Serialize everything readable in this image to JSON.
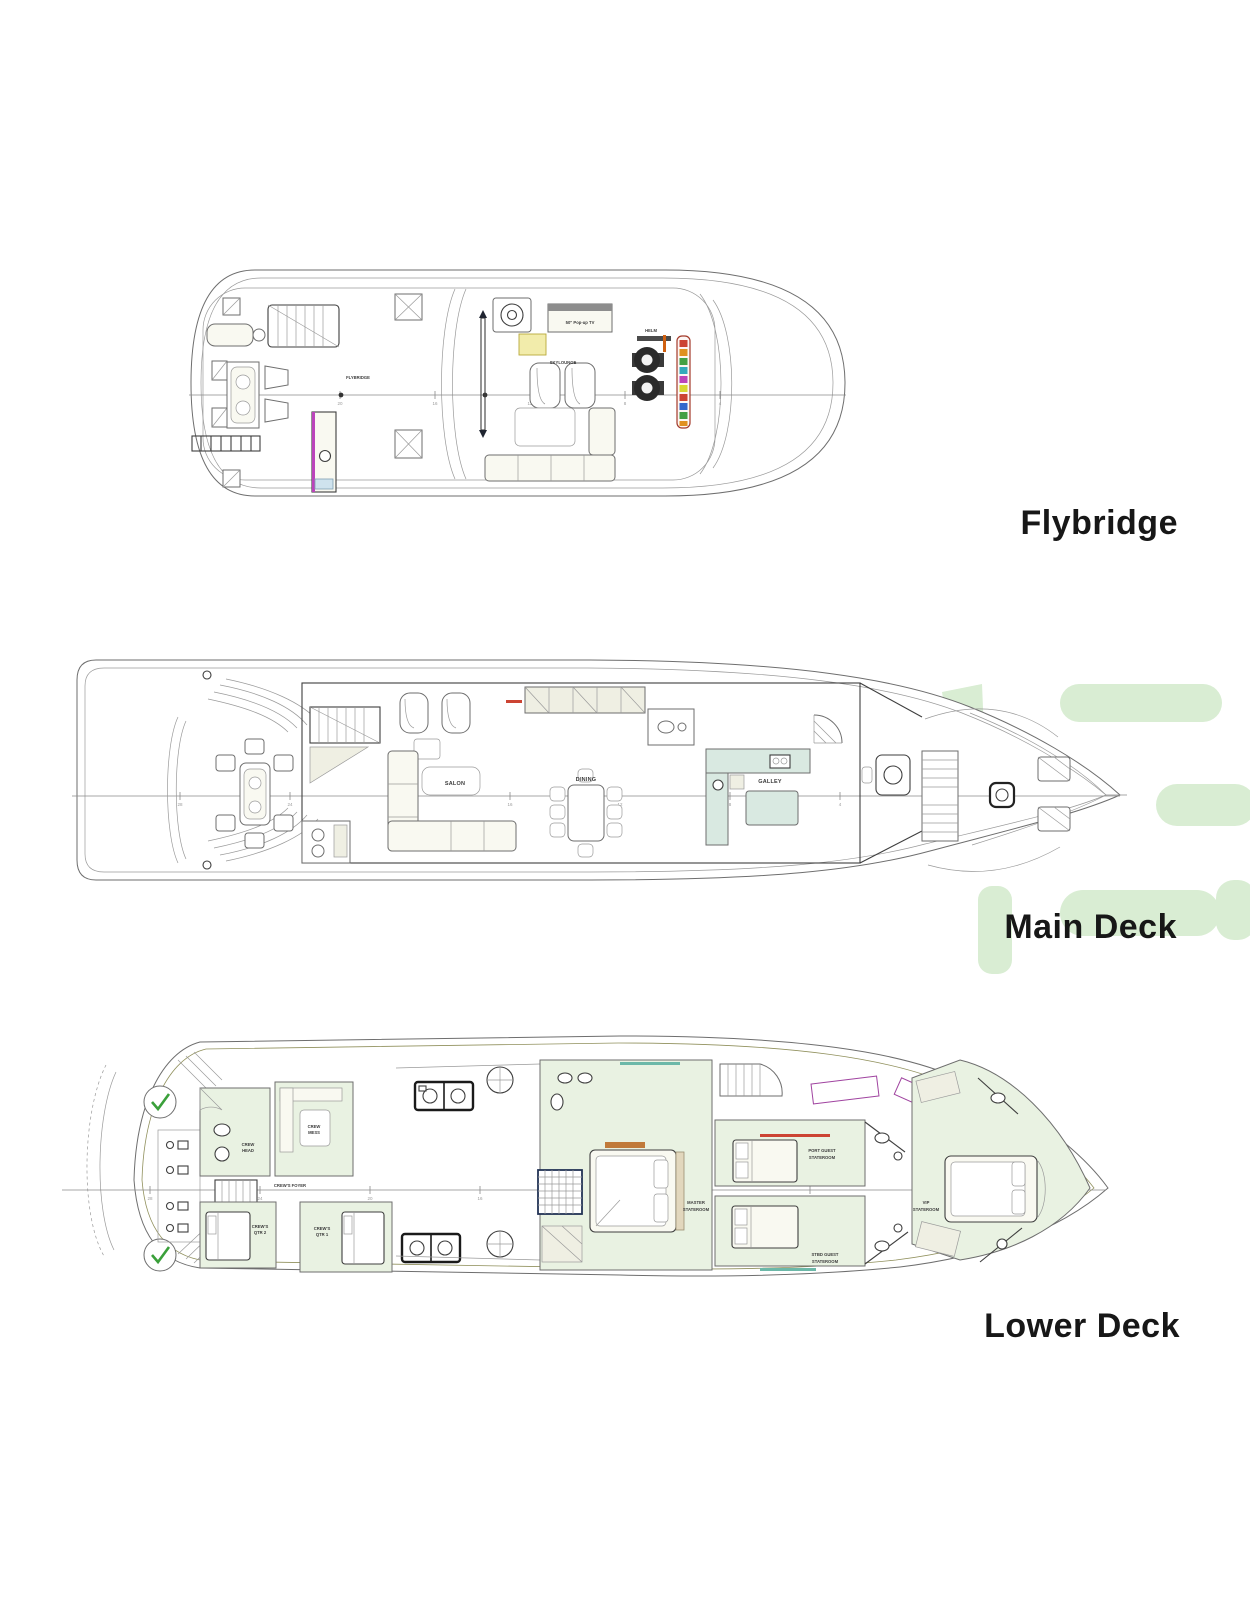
{
  "deck_labels": {
    "flybridge": "Flybridge",
    "main": "Main Deck",
    "lower": "Lower Deck"
  },
  "flybridge": {
    "rooms": {
      "flybridge": "FLYBRIDGE",
      "skylounge": "SKYLOUNGE",
      "helm": "HELM"
    },
    "tv_label": "50\" Pop-up TV"
  },
  "main": {
    "rooms": {
      "salon": "SALON",
      "dining": "DINING",
      "galley": "GALLEY"
    }
  },
  "lower": {
    "rooms": {
      "crew_mess": [
        "CREW",
        "MESS"
      ],
      "crew_head": [
        "CREW",
        "HEAD"
      ],
      "crew_foyer": "CREW'S FOYER",
      "crew_qtr2": [
        "CREW'S",
        "QTR 2"
      ],
      "crew_qtr1": [
        "CREW'S",
        "QTR 1"
      ],
      "master": [
        "MASTER",
        "STATEROOM"
      ],
      "port_guest": [
        "PORT GUEST",
        "STATEROOM"
      ],
      "stbd_guest": [
        "STBD GUEST",
        "STATEROOM"
      ],
      "vip": [
        "VIP",
        "STATEROOM"
      ]
    }
  },
  "stations": {
    "flybridge": [
      "24",
      "20",
      "16",
      "12",
      "8",
      "4"
    ],
    "main": [
      "28",
      "24",
      "20",
      "16",
      "12",
      "8",
      "4"
    ],
    "lower": [
      "28",
      "24",
      "20",
      "16",
      "12",
      "8",
      "4"
    ]
  },
  "colors": {
    "watermark_green": "#d9edd3",
    "check_green": "#3aa03a",
    "accent_magenta": "#bb44bb",
    "accent_red": "#cc4433",
    "accent_yellow": "#f2ecab",
    "accent_teal": "#6cb8a8",
    "counter_teal": "#d9e9e1",
    "label_black": "#171717"
  }
}
